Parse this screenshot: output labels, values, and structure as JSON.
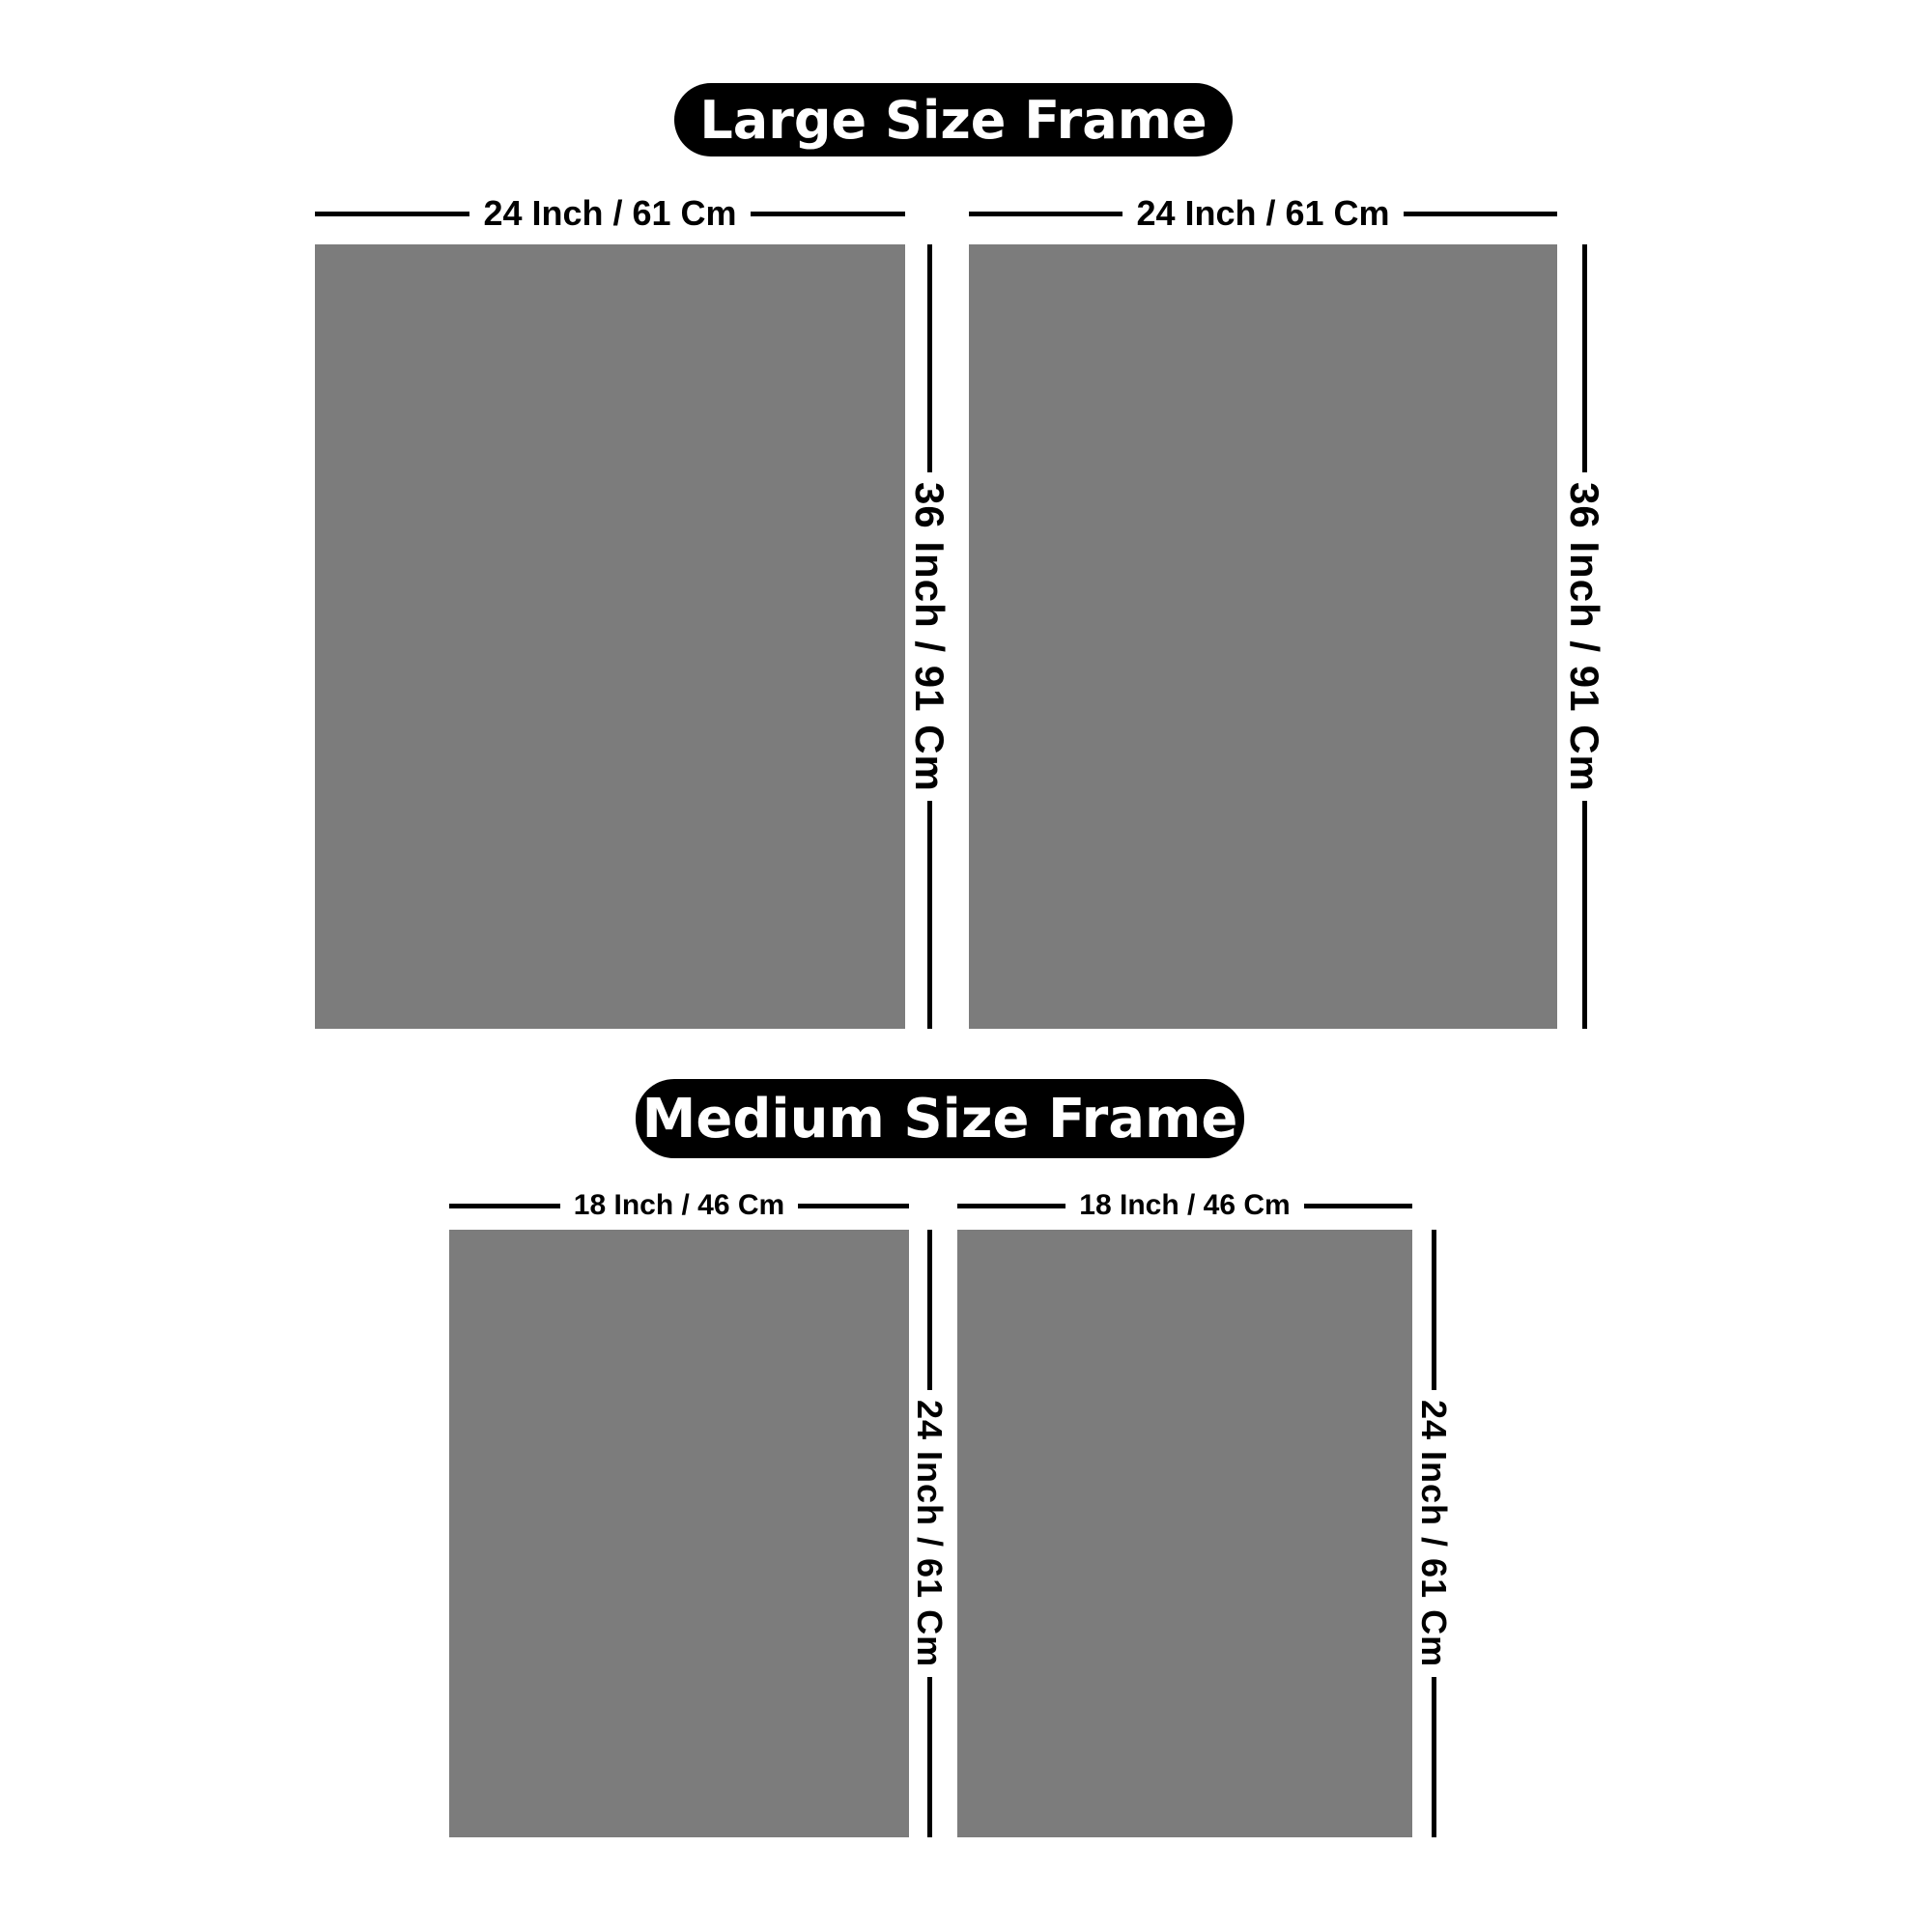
{
  "page": {
    "background": "#ffffff"
  },
  "colors": {
    "frame_fill": "#7c7c7c",
    "dimension_line": "#000000",
    "pill_background": "#000000",
    "pill_text": "#ffffff"
  },
  "sections": [
    {
      "title": "Large Size Frame",
      "frames": [
        {
          "width_label": "24 Inch / 61 Cm",
          "height_label": "36 Inch / 91 Cm"
        },
        {
          "width_label": "24 Inch / 61 Cm",
          "height_label": "36 Inch / 91 Cm"
        }
      ]
    },
    {
      "title": "Medium Size Frame",
      "frames": [
        {
          "width_label": "18 Inch / 46 Cm",
          "height_label": "24 Inch / 61 Cm"
        },
        {
          "width_label": "18 Inch / 46 Cm",
          "height_label": "24 Inch / 61 Cm"
        }
      ]
    }
  ]
}
